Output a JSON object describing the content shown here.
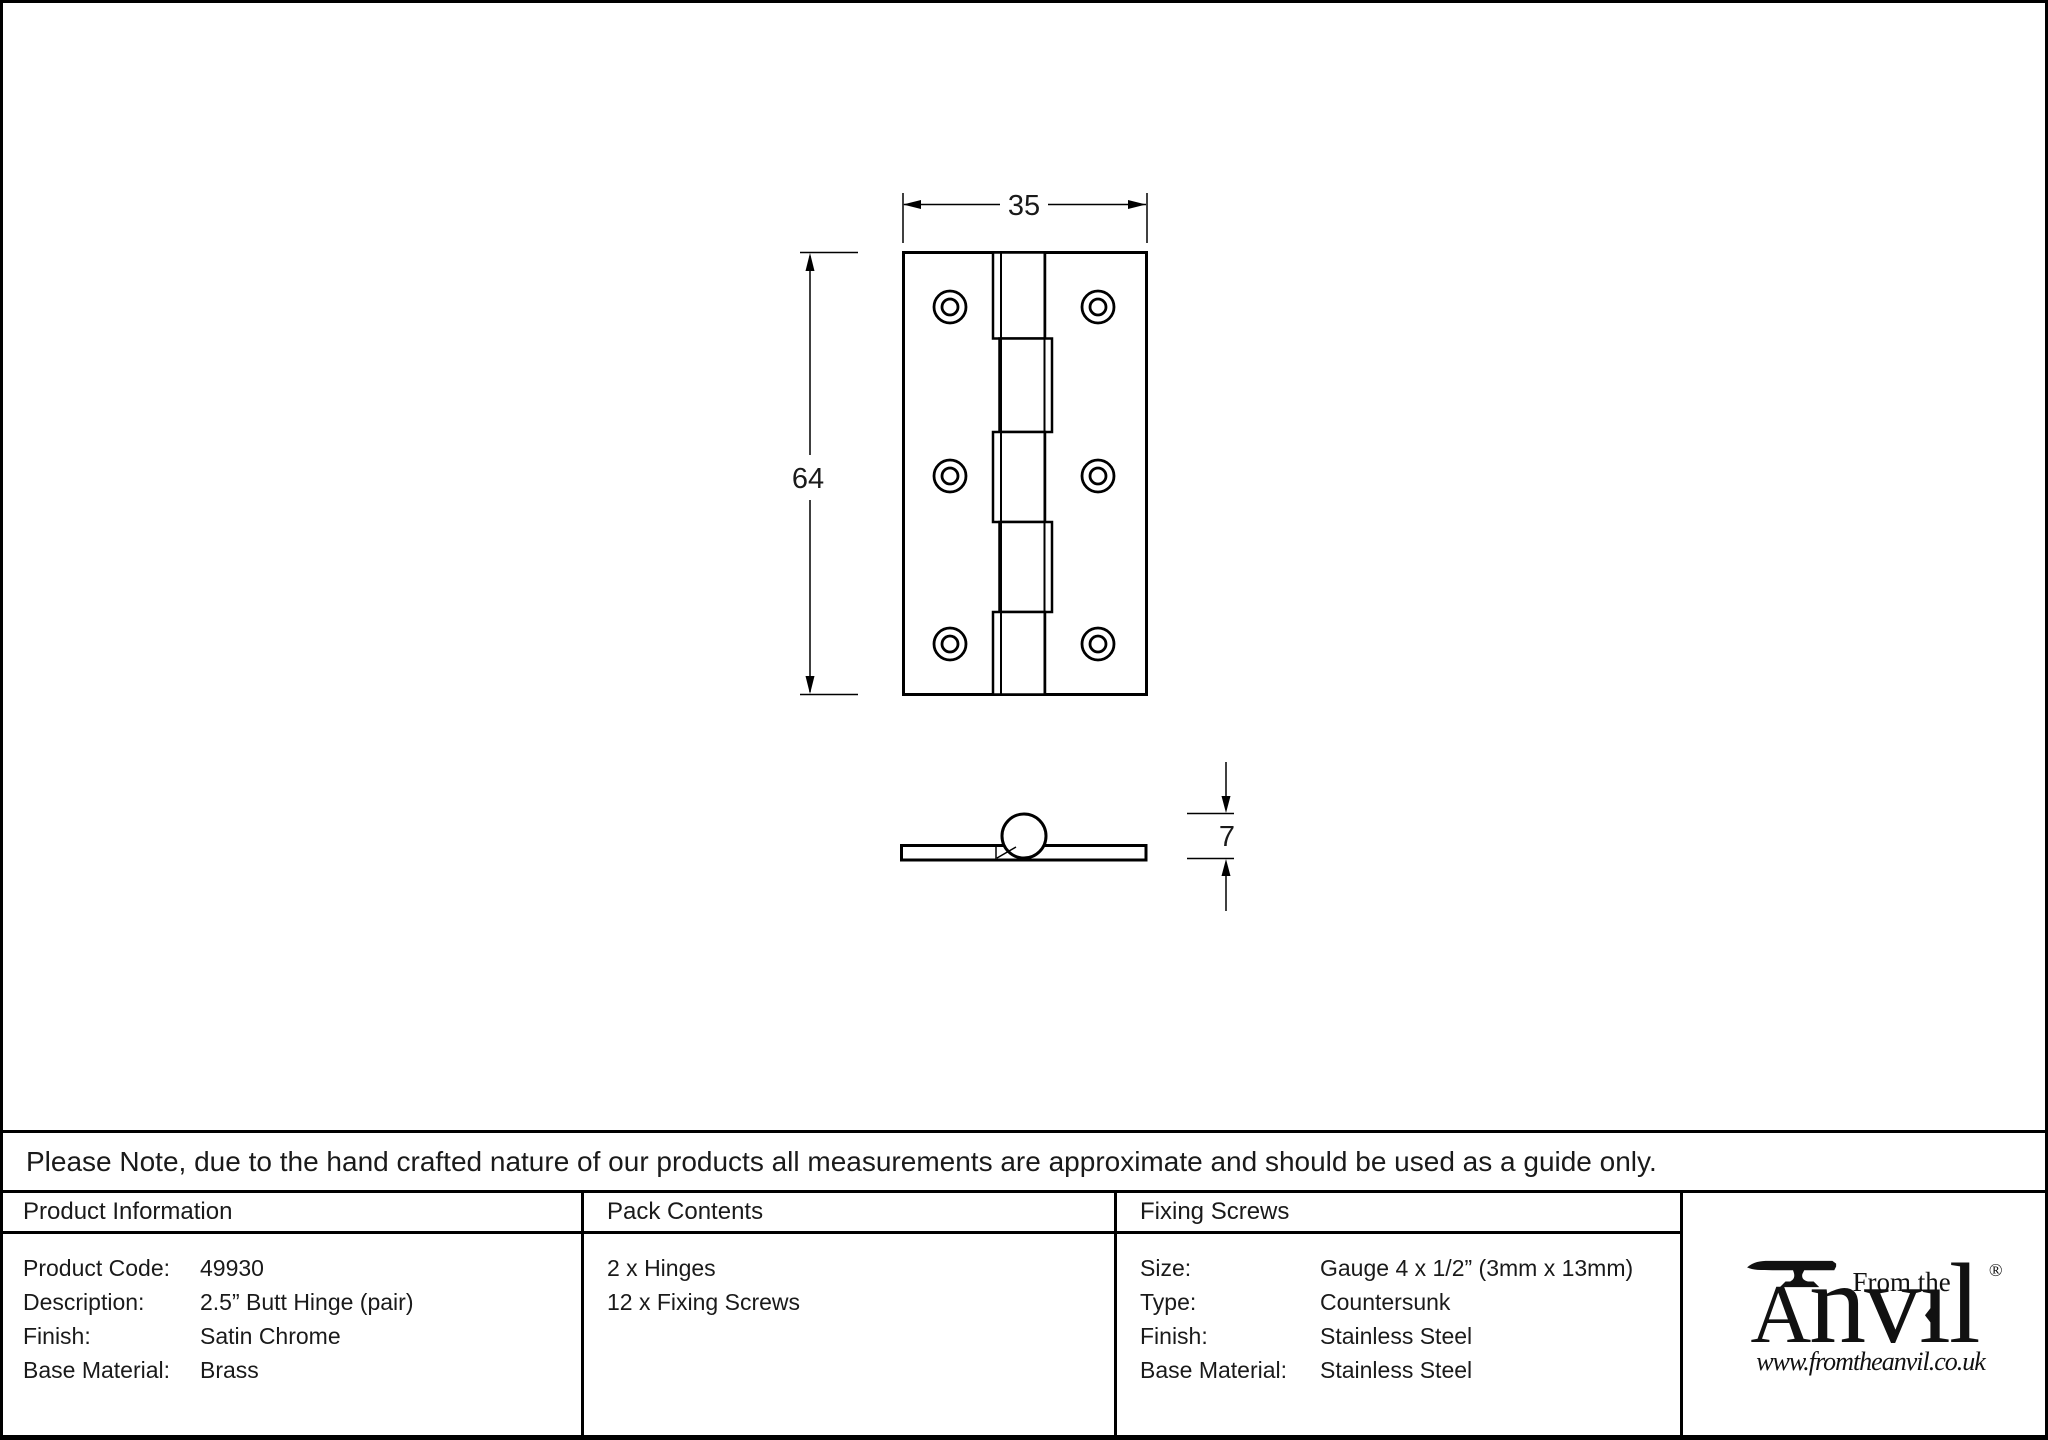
{
  "colors": {
    "line": "#000000",
    "text": "#1a1a1a"
  },
  "drawing": {
    "front_view": {
      "width_label": "35",
      "height_label": "64"
    },
    "side_view": {
      "thickness_label": "7"
    }
  },
  "note": {
    "text": "Please Note, due to the hand crafted nature of our products all measurements are approximate and should be used as a guide only."
  },
  "product_information": {
    "header": "Product Information",
    "rows": [
      {
        "label": "Product Code:",
        "value": "49930"
      },
      {
        "label": "Description:",
        "value": "2.5” Butt Hinge (pair)"
      },
      {
        "label": "Finish:",
        "value": "Satin Chrome"
      },
      {
        "label": "Base Material:",
        "value": "Brass"
      }
    ]
  },
  "pack_contents": {
    "header": "Pack Contents",
    "items": [
      {
        "text": "2 x Hinges"
      },
      {
        "text": "12 x Fixing Screws"
      }
    ]
  },
  "fixing_screws": {
    "header": "Fixing Screws",
    "rows": [
      {
        "label": "Size:",
        "value": "Gauge 4 x 1/2” (3mm x 13mm)"
      },
      {
        "label": "Type:",
        "value": "Countersunk"
      },
      {
        "label": "Finish:",
        "value": "Stainless Steel"
      },
      {
        "label": "Base Material:",
        "value": "Stainless Steel"
      }
    ]
  },
  "logo": {
    "tagline": "From the",
    "registered": "®",
    "name_a": "A",
    "name_nv": "nv",
    "name_i": "ı",
    "name_i_dot": "♦",
    "name_l": "l",
    "website": "www.fromtheanvil.co.uk"
  }
}
